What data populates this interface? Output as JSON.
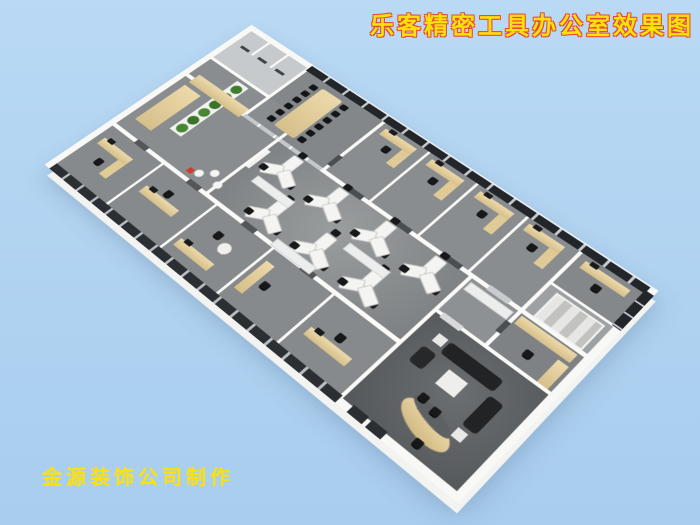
{
  "title": {
    "text": "乐客精密工具办公室效果图",
    "fill_color": "#ffe10a",
    "outline_color": "#e8483c"
  },
  "watermark": {
    "text": "金源装饰公司制作",
    "color": "#ffe10a"
  },
  "background": {
    "sky_color": "#b3d4f0"
  },
  "scene": {
    "type": "isometric-3d-office-floorplan-render",
    "palette": {
      "exterior_walls": "#f8f8f6",
      "floor": "#8b8e90",
      "executive_floor": "#606366",
      "wood_furniture": "#e0cb98",
      "chairs_sofas": "#17181a",
      "window_glass": "#22262a",
      "window_frame": "#c6cbd0",
      "plants": "#3f7c2d"
    },
    "rooms": [
      "restrooms",
      "conference-room",
      "private-offices-window-row",
      "corner-office",
      "stairwell",
      "storage-room",
      "open-plan-office-y-desks",
      "plant-lounge",
      "lower-glass-wall-offices",
      "executive-office-with-sofa-and-curved-desk"
    ]
  }
}
